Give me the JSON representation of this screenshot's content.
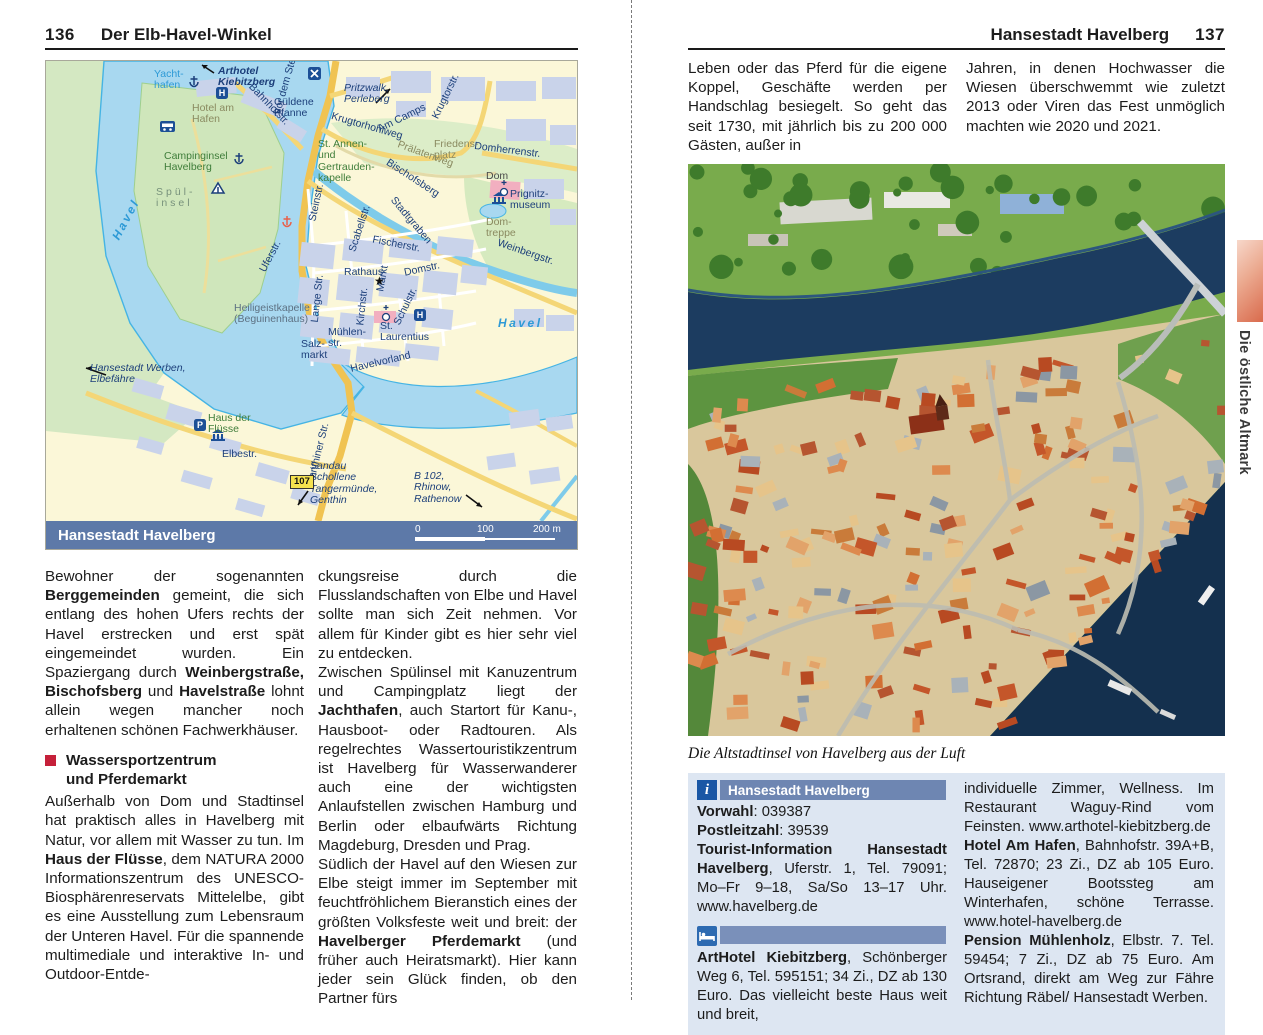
{
  "left_page": {
    "page_number": "136",
    "header_title": "Der Elb-Havel-Winkel",
    "map": {
      "title_bar": "Hansestadt Havelberg",
      "scale": {
        "zero": "0",
        "hundred": "100",
        "two_hundred": "200 m"
      },
      "icons": {
        "hotel": "H",
        "parking": "P",
        "route": "107",
        "star": "★",
        "crossing": "✕"
      },
      "labels": {
        "yachthafen": "Yacht-\nhafen",
        "arthotel": "Arthotel\nKiebitzberg",
        "gueldene": "Güldene\nPfanne",
        "hotel_am_hafen": "Hotel am\nHafen",
        "bahnhofstr": "Bahnhofstr.",
        "vor_dem_steintor": "Vor dem Steintor",
        "pritzwalk": "Pritzwalk,\nPerleberg",
        "krugtorhohlweg": "Krugtorhohlweg",
        "am_camps": "Am Camps",
        "krugtorstr": "Krugtorstr.",
        "st_annen": "St. Annen-\nund\nGertrauden-\nkapelle",
        "praelatenweg": "Prälatenweg",
        "friedensplatz": "Friedens-\nplatz",
        "domherrenstr": "Domherrenstr.",
        "dom": "Dom",
        "prignitzmuseum": "Prignitz-\nmuseum",
        "domtreppe": "Dom-\ntreppe",
        "weinbergstr": "Weinbergstr.",
        "bischofsberg": "Bischofsberg",
        "stadtgraben": "Stadtgraben",
        "fischerstr": "Fischerstr.",
        "scabellstr": "Scabellstr.",
        "steinstr": "Steinstr.",
        "rathaus": "Rathaus",
        "markt": "Markt",
        "domstr": "Domstr.",
        "kirchstr": "Kirchstr.",
        "schulstr": "Schulstr.",
        "lange_str": "Lange Str.",
        "uferstr": "Uferstr.",
        "heiligeistkapelle": "Heiligeistkapelle\n(Beguinenhaus)",
        "salzmarkt": "Salz-\nmarkt",
        "muehlenstr": "Mühlen-\nstr.",
        "st_laurentius": "St.\nLaurentius",
        "havelvorland": "Havelvorland",
        "havel_right": "Havel",
        "havel_left": "Havel",
        "spuelinsel": "Spül-\ninsel",
        "campinginsel": "Campinginsel\nHavelberg",
        "werben": "Hansestadt Werben,\nElbefähre",
        "haus_der_fluesse": "Haus der\nFlüsse",
        "elbestr": "Elbestr.",
        "genthiner_str": "Genthiner Str.",
        "sandau": "Sandau\nSchollene\nTangermünde,\nGenthin",
        "b102": "B 102,\nRhinow,\nRathenow"
      }
    },
    "col1": {
      "p1_s1": "Bewohner der sogenannten ",
      "p1_b1": "Berggemeinden",
      "p1_s2": " gemeint, die sich entlang des hohen Ufers rechts der Havel erstrecken und erst spät eingemeindet wurden. Ein Spaziergang durch ",
      "p1_b2": "Weinbergstraße, Bischofsberg",
      "p1_s3": " und ",
      "p1_b3": "Havelstraße",
      "p1_s4": " lohnt allein wegen mancher noch erhaltenen schönen Fachwerkhäuser.",
      "heading": "Wassersportzentrum\nund Pferdemarkt",
      "p2_s1": "Außerhalb von Dom und Stadtinsel hat praktisch alles in Havelberg mit Natur, vor allem mit Wasser zu tun. Im ",
      "p2_b1": "Haus der Flüsse",
      "p2_s2": ", dem NATURA 2000 Informationszentrum des UNESCO-Biosphärenreservats Mittelelbe, gibt es eine Ausstellung zum Lebensraum der Unteren Havel. Für die spannende multimediale und interaktive In- und Outdoor-Entde-"
    },
    "col2": {
      "p1": "ckungsreise durch die Flusslandschaften von Elbe und Havel sollte man sich Zeit nehmen. Vor allem für Kinder gibt es hier sehr viel zu entdecken.",
      "p2_s1": "Zwischen Spülinsel mit Kanuzentrum und Campingplatz liegt der ",
      "p2_b1": "Jachthafen",
      "p2_s2": ", auch Startort für Kanu-, Hausboot- oder Radtouren. Als regelrechtes Wassertouristikzentrum ist Havelberg für Wasserwanderer auch eine der wichtigsten Anlaufstellen zwischen Hamburg und Berlin oder elbaufwärts Richtung Magdeburg, Dresden und Prag.",
      "p3_s1": "Südlich der Havel auf den Wiesen zur Elbe steigt immer im September mit feuchtfröhlichem Bieranstich eines der größten Volksfeste weit und breit: der ",
      "p3_b1": "Havelberger Pferdemarkt",
      "p3_s2": " (und früher auch Heiratsmarkt). Hier kann jeder sein Glück finden, ob den Partner fürs"
    }
  },
  "right_page": {
    "page_number": "137",
    "header_title": "Hansestadt Havelberg",
    "intro_col1": "Leben oder das Pferd für die eigene Koppel, Geschäfte werden per Handschlag besiegelt. So geht das seit 1730, mit jährlich bis zu 200 000 Gästen, außer in",
    "intro_col2": "Jahren, in denen Hochwasser die Wiesen überschwemmt wie zuletzt 2013 oder Viren das Fest unmöglich machten wie 2020 und 2021.",
    "photo_caption": "Die Altstadtinsel von Havelberg aus der Luft",
    "info_box": {
      "header": "Hansestadt Havelberg",
      "vorwahl_label": "Vorwahl",
      "vorwahl_value": ": 039387",
      "plz_label": "Postleitzahl",
      "plz_value": ": 39539",
      "tourist_label": "Tourist-Information Hansestadt Havelberg",
      "tourist_value": ", Uferstr. 1, Tel. 79091; Mo–Fr 9–18, Sa/So 13–17 Uhr. www.havelberg.de",
      "arthotel_label": "ArtHotel Kiebitzberg",
      "arthotel_value": ", Schönberger Weg 6, Tel. 595151; 34 Zi., DZ ab 130 Euro. Das vielleicht beste Haus weit und breit,",
      "right_p1": "individuelle Zimmer, Wellness. Im Restaurant Waguy-Rind vom Feinsten. www.arthotel-kiebitzberg.de",
      "hafen_label": "Hotel Am Hafen",
      "hafen_value": ", Bahnhofstr. 39A+B, Tel. 72870; 23 Zi., DZ ab 105 Euro. Hauseigener Bootssteg am Winterhafen, schöne Terrasse. www.hotel-havelberg.de",
      "pension_label": "Pension Mühlenholz",
      "pension_value": ", Elbstr. 7. Tel. 59454; 7 Zi., DZ ab 75 Euro. Am Ortsrand, direkt am Weg zur Fähre Richtung Räbel/ Hansestadt Werben."
    },
    "margin_tab": "Die östliche Altmark"
  }
}
